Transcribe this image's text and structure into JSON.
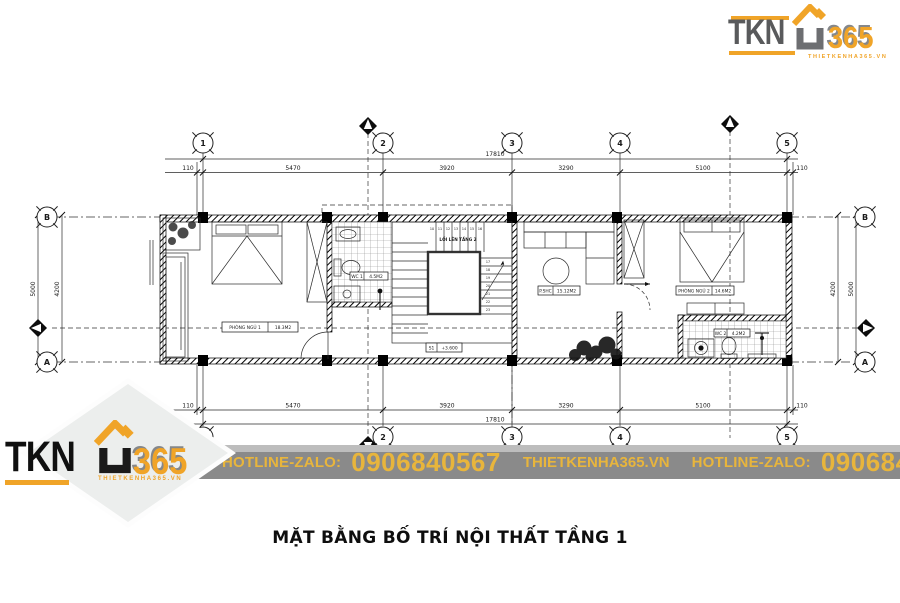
{
  "logo": {
    "tkn": "TKN",
    "n365": "365",
    "tagline": "THIETKENHA365.VN"
  },
  "banner": {
    "hotline1": "HOTLINE-ZALO:",
    "phone1": "0906840567",
    "site": "THIETKENHA365.VN",
    "hotline2": "HOTLINE-ZALO:",
    "phone2": "0906840567"
  },
  "caption": "MẶT BẰNG BỐ TRÍ NỘI THẤT TẦNG 1",
  "plan": {
    "grid": {
      "cols": [
        "1",
        "2",
        "3",
        "4",
        "5"
      ],
      "rows": [
        "B",
        "A"
      ]
    },
    "dims": {
      "total": "17810",
      "top": [
        "110",
        "5470",
        "3920",
        "3290",
        "5100",
        "110"
      ],
      "bottom": [
        "110",
        "5470",
        "3920",
        "3290",
        "5100",
        "110"
      ],
      "left_outer": "5000",
      "left_inner": "4200",
      "right_inner": "4200",
      "right_outer": "5000"
    },
    "rooms": {
      "bedroom1": {
        "label": "PHÒNG NGỦ 1",
        "area": "18.3M2"
      },
      "wc1": {
        "label": "WC 1",
        "area": "4.5M2"
      },
      "shc": {
        "label": "P.SHC",
        "area": "15.12M2"
      },
      "bedroom2": {
        "label": "PHÒNG NGỦ 2",
        "area": "14.6M2"
      },
      "wc2": {
        "label": "WC 2",
        "area": "4.2M2"
      }
    },
    "stair": {
      "up_label": "LỐI LÊN TẦNG 2",
      "tag": "S1",
      "level": "+3.600",
      "top_steps": [
        "10",
        "11",
        "12",
        "13",
        "14",
        "15",
        "16"
      ],
      "right_steps": [
        "17",
        "18",
        "19",
        "20",
        "21",
        "22",
        "23"
      ]
    }
  }
}
